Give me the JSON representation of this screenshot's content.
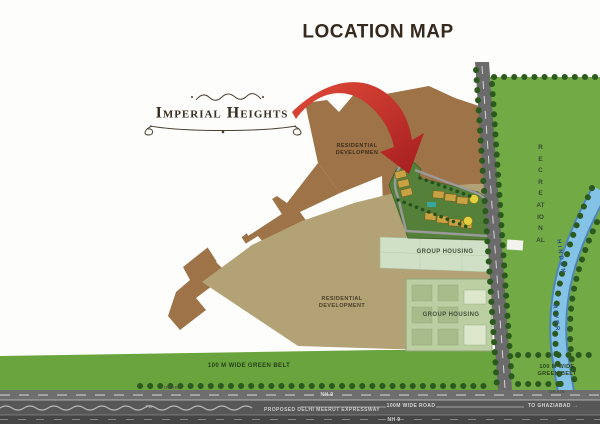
{
  "title": "LOCATION MAP",
  "logo": {
    "name": "Imperial Heights"
  },
  "areas": {
    "residential_upper_line1": "RESIDENTIAL",
    "residential_upper_line2": "DEVELOPMEN",
    "residential_lower_line1": "RESIDENTIAL",
    "residential_lower_line2": "DEVELOPMENT",
    "group_housing_upper": "GROUP HOUSING",
    "group_housing_lower": "GROUP HOUSING",
    "recreational": "RECREATIONAL",
    "green_belt_left": "100 M WIDE GREEN BELT",
    "green_belt_right_line1": "100 M WIDE",
    "green_belt_right_line2": "GREEN BELT",
    "drain_left": "DRAIN",
    "drain_right": "DRAIN"
  },
  "river": {
    "word1": "HINDON",
    "word2": "RIVER"
  },
  "roads": {
    "nh9_upper": "NH 9",
    "nh9_lower": "NH 9",
    "expressway": "PROPOSED DELHI MEERUT EXPRESSWAY",
    "wide_road": "100M WIDE ROAD",
    "to_ghaziabad": "TO GHAZIABAD",
    "arrow_glyph": "→",
    "fb": "FB"
  },
  "colors": {
    "residential_upper_brown": "#9d7347",
    "residential_lower_tan": "#b2a276",
    "green_belt": "#6aa43e",
    "recreational_green": "#72ab46",
    "group_housing_light": "#cfe0c6",
    "group_housing_block": "#bccfa3",
    "road_gray": "#6b6b6b",
    "expressway_gray": "#575757",
    "river_blue": "#85c3e6",
    "arrow_red": "#c2262a",
    "site_green": "#54803a",
    "building_gold": "#c9a243"
  }
}
